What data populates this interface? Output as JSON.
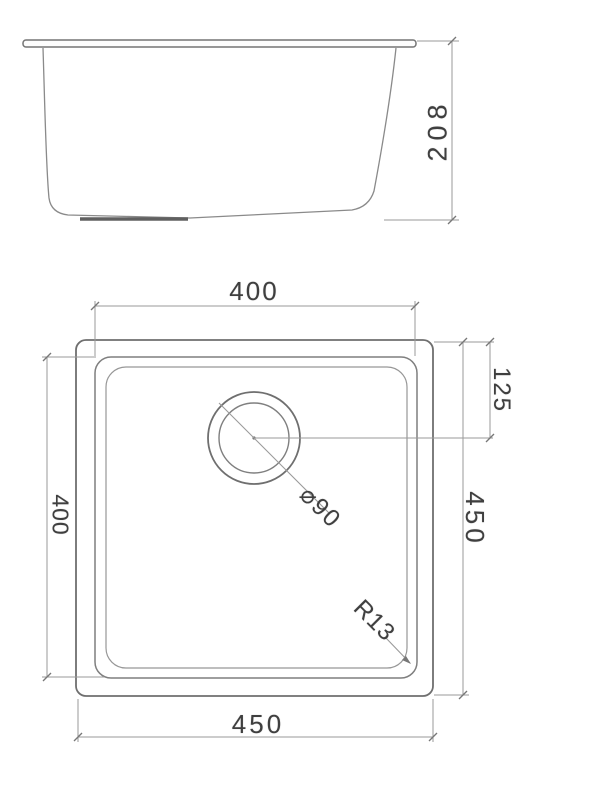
{
  "colors": {
    "background": "#ffffff",
    "object_line": "#6f6f6f",
    "thin_line": "#8a8a8a",
    "dimension_line": "#9a9a9a",
    "text": "#3f3f3f"
  },
  "dimensions": {
    "elevation_height": {
      "label": "208"
    },
    "plan_inner_width": {
      "label": "400"
    },
    "plan_inner_height": {
      "label": "400"
    },
    "plan_outer_width": {
      "label": "450"
    },
    "plan_outer_height": {
      "label": "450"
    },
    "drain_offset": {
      "label": "125"
    },
    "drain_diameter": {
      "label": "⌀90"
    },
    "corner_radius": {
      "label": "R13"
    }
  }
}
